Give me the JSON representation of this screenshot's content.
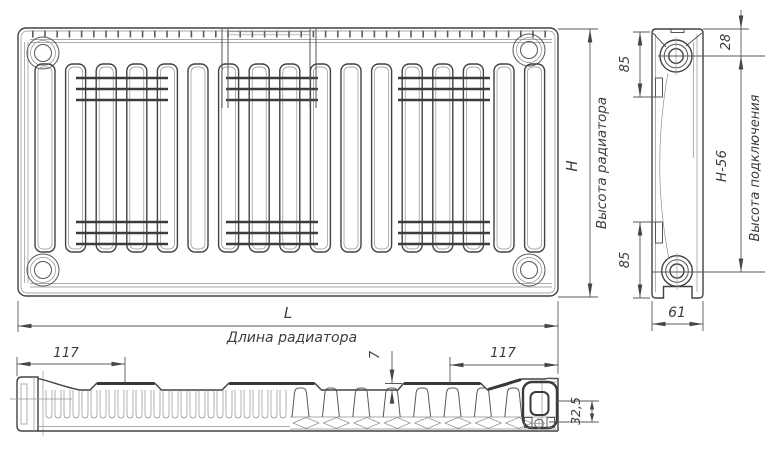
{
  "drawing": {
    "front_view": {
      "height_symbol": "H",
      "height_caption": "Высота радиатора",
      "length_symbol": "L",
      "length_caption": "Длина радиатора"
    },
    "side_view": {
      "top_offset": "28",
      "bracket_top": "85",
      "bracket_bottom": "85",
      "depth": "61",
      "connection_height": "H-56",
      "connection_caption": "Высота подключения"
    },
    "bottom_view": {
      "left_margin": "117",
      "right_margin": "117",
      "fin_height": "7",
      "axis_offset": "32,5"
    },
    "colors": {
      "line": "#424242",
      "line_light": "#8f8f8f",
      "text": "#3d3d3d",
      "background": "#ffffff"
    }
  }
}
